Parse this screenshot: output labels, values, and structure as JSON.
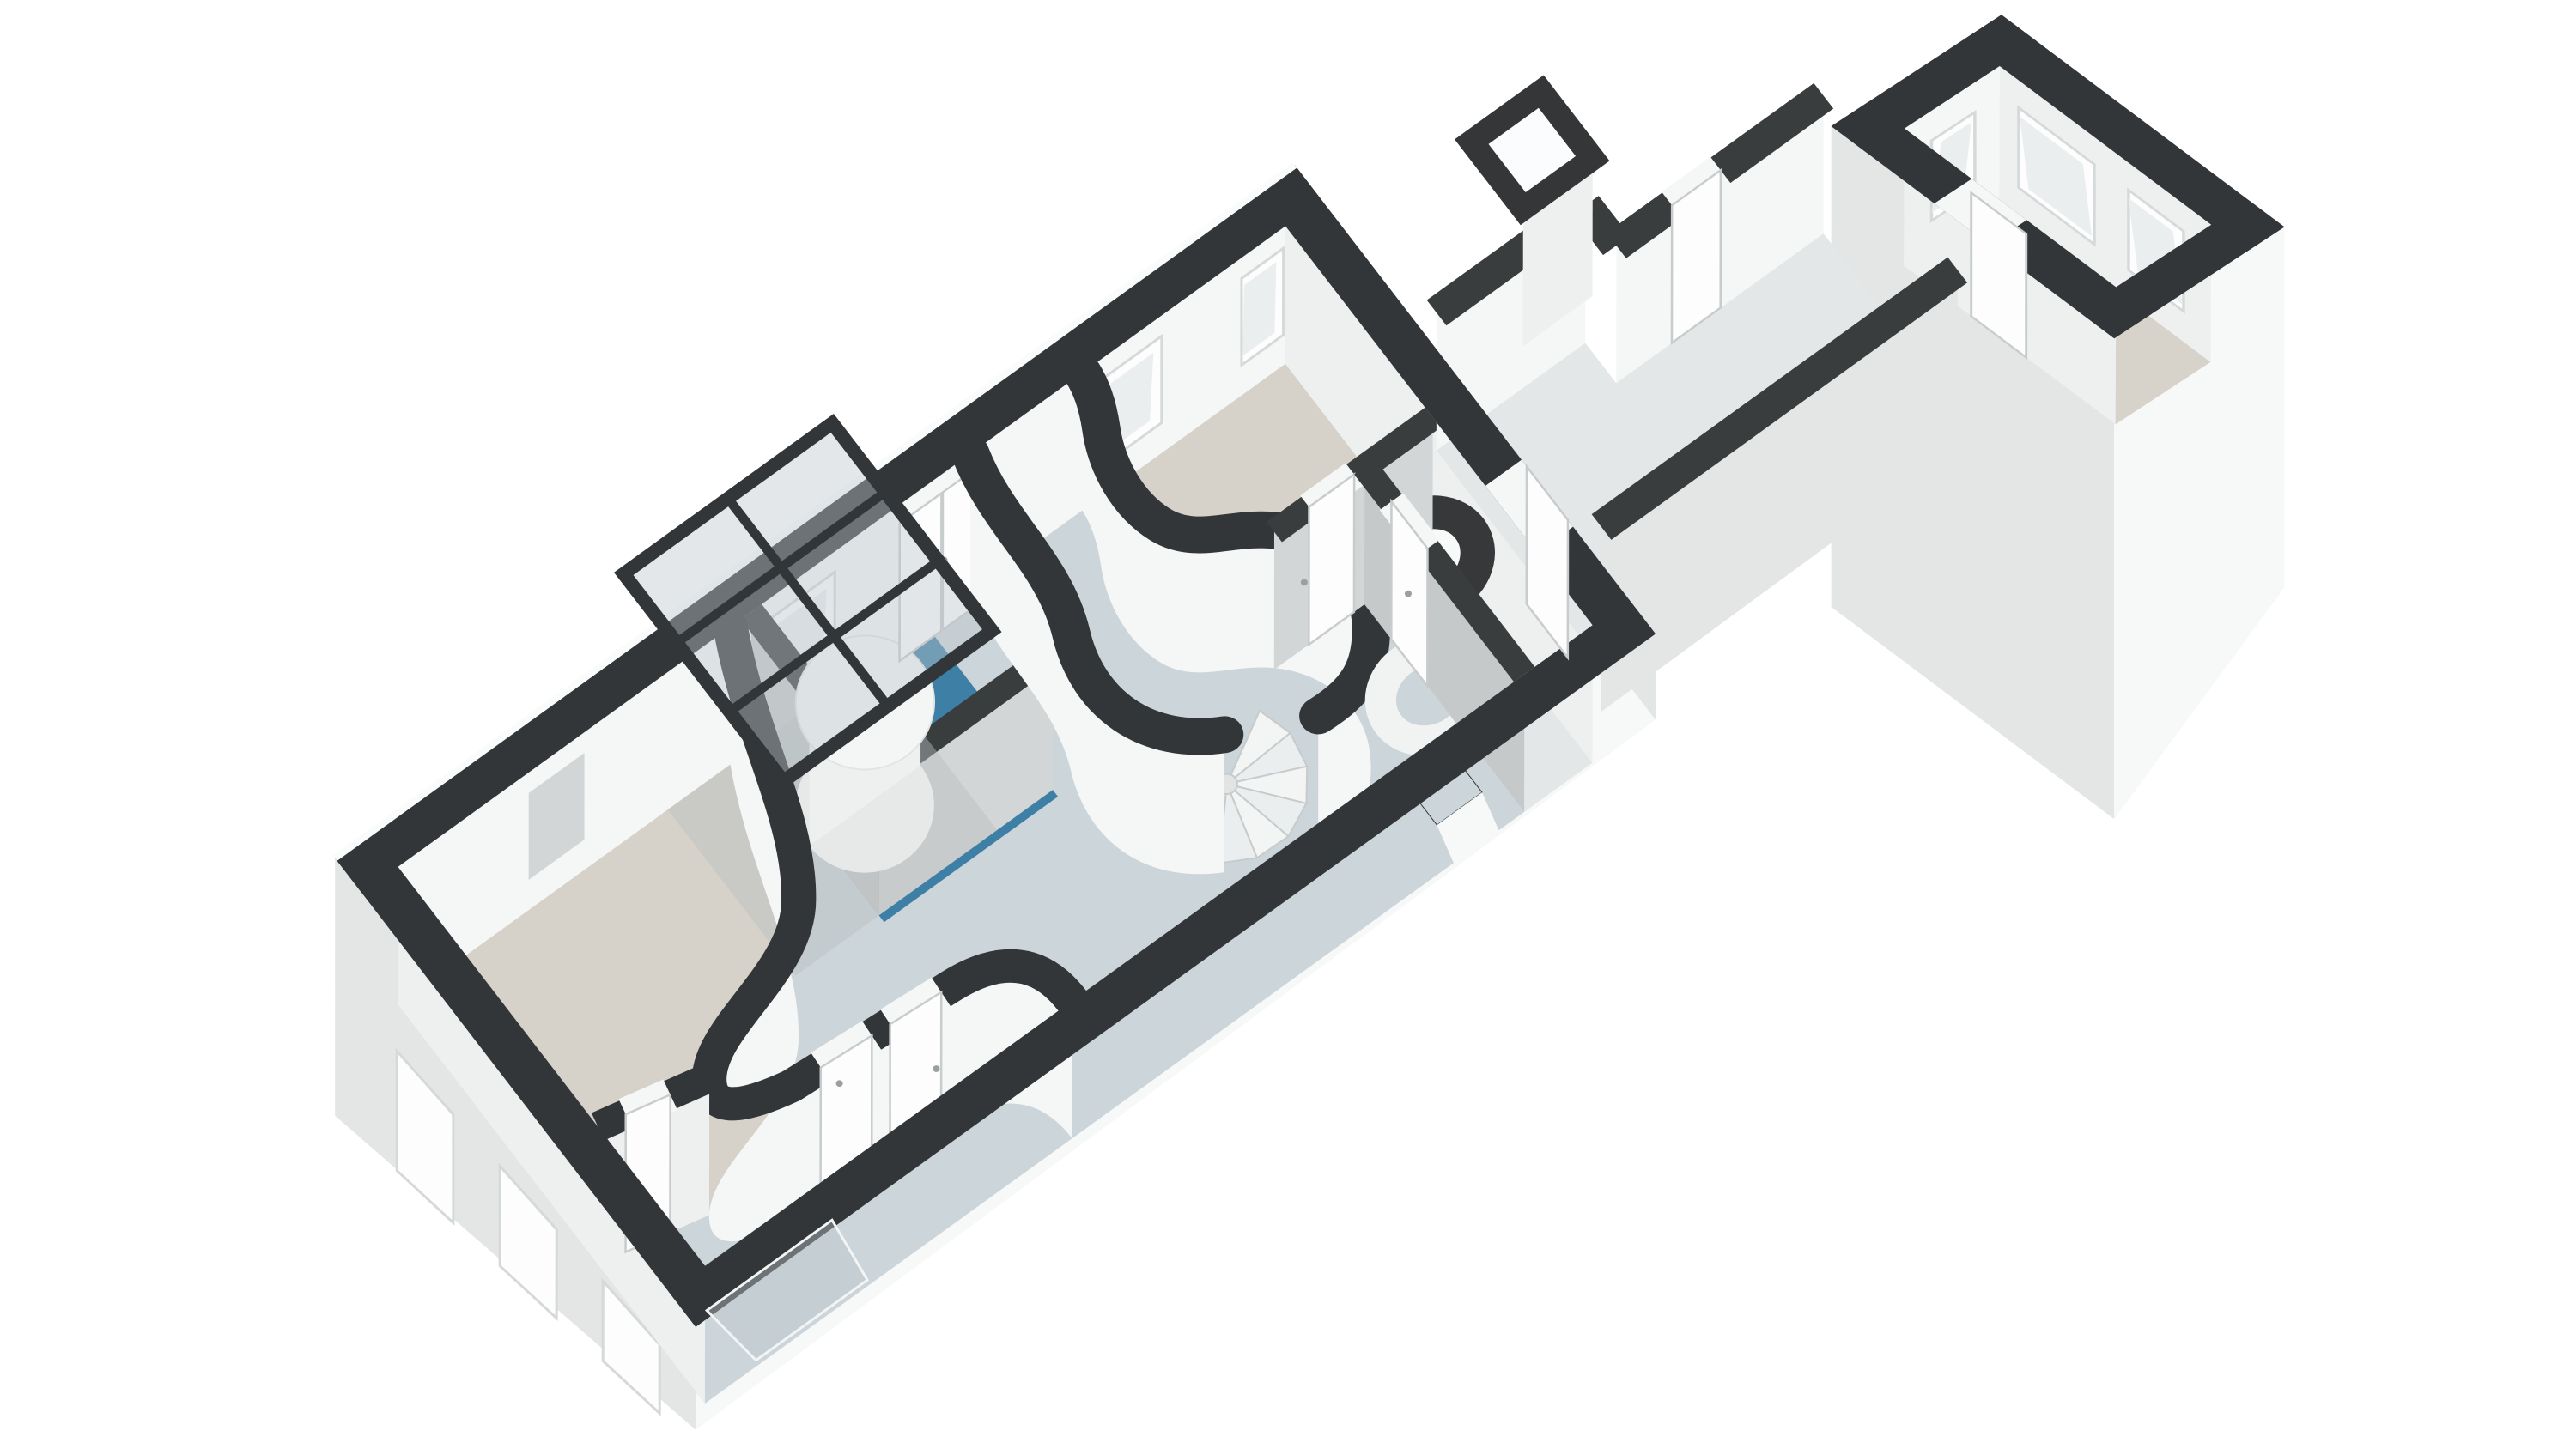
{
  "scene": {
    "type": "3d-floorplan-render",
    "view": "axonometric-dollhouse",
    "background": "#ffffff"
  },
  "colors": {
    "background": "#ffffff",
    "wall_top": "#333638",
    "wall_top_inner": "#3a3d3e",
    "floor_beige": "#d7d2c9",
    "floor_hall": "#ccd5d9",
    "floor_bathroom": "#3e80a5",
    "floor_annex": "#d8d3ca",
    "floor_connector": "#e4e7e7",
    "face_white": "#f5f6f6",
    "face_light": "#eef0f0",
    "face_gray": "#c6c9c9",
    "face_gray_light": "#d3d6d6",
    "facade_white": "#f7f8f8",
    "facade_shade": "#e4e6e6",
    "glass": "#bcc6cb",
    "window_frame": "#fdfdfd",
    "window_pane": "#eaeeef",
    "stair_step": "#f3f4f4",
    "pod": "#f4f6f6",
    "handle": "#9aa0a0",
    "underlay_shadow": "#b9bfc1"
  },
  "rooms": [
    {
      "id": "living-room-sw",
      "floor": "beige"
    },
    {
      "id": "hall",
      "floor": "blue-gray"
    },
    {
      "id": "bathroom",
      "floor": "teal"
    },
    {
      "id": "bedroom-ne",
      "floor": "beige"
    },
    {
      "id": "corridor-ne",
      "floor": "light-gray"
    },
    {
      "id": "connector-passage",
      "floor": "light-gray"
    },
    {
      "id": "annex-room",
      "floor": "beige"
    }
  ],
  "elements": {
    "spiral_staircase_steps": 10,
    "skylight_grid": {
      "cols": 2,
      "rows": 3
    },
    "curved_walls": 3,
    "sw_facade_windows": 3,
    "nw_wall_windows": 3,
    "annex_windows": 3,
    "doors": 9,
    "round_pod": 1
  }
}
